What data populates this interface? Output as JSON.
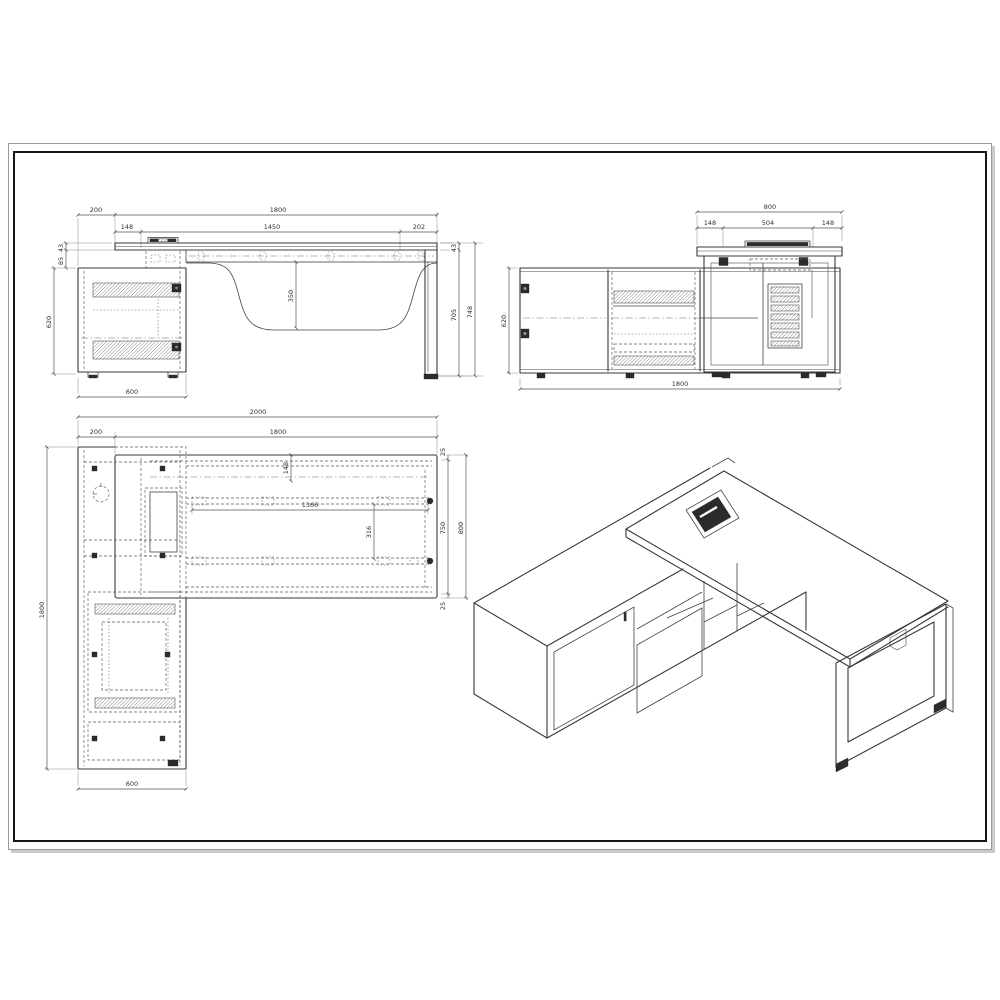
{
  "palette": {
    "paper": "#ffffff",
    "frame_border": "#161616",
    "line_work": "#383838",
    "dimension_text": "#303030",
    "dark_fill": "#2b2b2b",
    "shadow": "#c9c9c9"
  },
  "front_elevation": {
    "dims": {
      "offset_left": "200",
      "total_width": "1800",
      "grommet_inset": "148",
      "mid_span": "1450",
      "end_span": "202",
      "top_thickness": "43",
      "beam_depth": "85",
      "cabinet_height": "620",
      "panel_drop": "350",
      "right_top_thickness": "43",
      "underside_height": "705",
      "overall_height": "748",
      "cabinet_depth": "600"
    }
  },
  "side_elevation": {
    "dims": {
      "desk_depth": "800",
      "front_inset": "148",
      "grommet_width": "504",
      "back_inset": "148",
      "cabinet_height": "620",
      "cabinet_length": "1800"
    }
  },
  "plan_view": {
    "dims": {
      "overall_length": "2000",
      "return_overhang": "200",
      "desk_length": "1800",
      "grommet_inset": "148",
      "rail_length": "1366",
      "rail_inset": "316",
      "edge_gap_top": "25",
      "frame_depth": "750",
      "desk_depth": "800",
      "edge_gap_bottom": "25",
      "return_length": "1800",
      "return_depth": "600"
    }
  }
}
